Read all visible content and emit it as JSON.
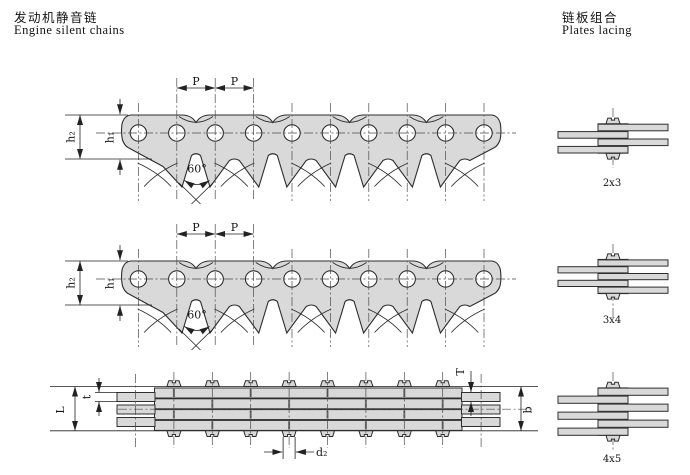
{
  "titles": {
    "left_zh": "发动机静音链",
    "left_en": "Engine silent chains",
    "right_zh": "链板组合",
    "right_en": "Plates lacing"
  },
  "dims": {
    "p": "P",
    "h1": "h₁",
    "h2": "h₂",
    "angle": "60°",
    "L": "L",
    "t": "t",
    "T": "T",
    "b": "b",
    "d2": "d₂"
  },
  "lacing_labels": {
    "a": "2x3",
    "b": "3x4",
    "c": "4x5"
  }
}
